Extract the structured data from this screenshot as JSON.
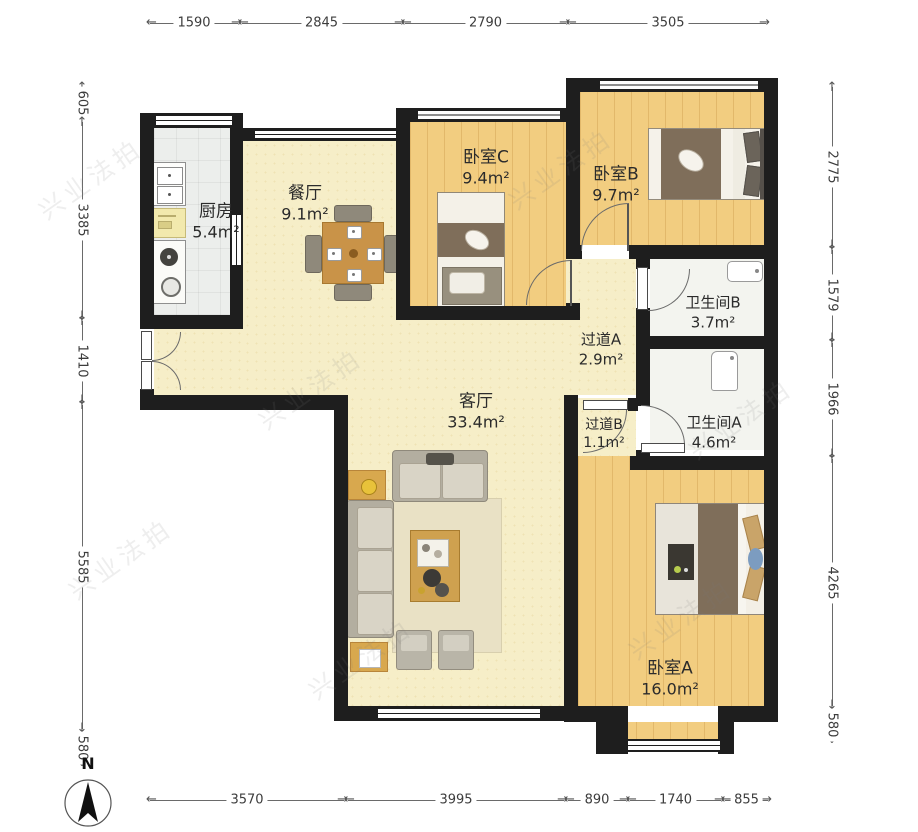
{
  "compass": {
    "label": "N"
  },
  "watermark": {
    "text": "兴业法拍"
  },
  "rooms": {
    "kitchen": {
      "name": "厨房",
      "area": "5.4m²"
    },
    "dining": {
      "name": "餐厅",
      "area": "9.1m²"
    },
    "bedroom_c": {
      "name": "卧室C",
      "area": "9.4m²"
    },
    "bedroom_b": {
      "name": "卧室B",
      "area": "9.7m²"
    },
    "bath_b": {
      "name": "卫生间B",
      "area": "3.7m²"
    },
    "hall_a": {
      "name": "过道A",
      "area": "2.9m²"
    },
    "bath_a": {
      "name": "卫生间A",
      "area": "4.6m²"
    },
    "hall_b": {
      "name": "过道B",
      "area": "1.1m²"
    },
    "living": {
      "name": "客厅",
      "area": "33.4m²"
    },
    "bedroom_a": {
      "name": "卧室A",
      "area": "16.0m²"
    }
  },
  "dimensions": {
    "top": [
      "1590",
      "2845",
      "2790",
      "3505"
    ],
    "left": [
      "605",
      "3385",
      "1410",
      "5585",
      "580"
    ],
    "right": [
      "2775",
      "1579",
      "1966",
      "4265",
      "580"
    ],
    "bottom": [
      "3570",
      "3995",
      "890",
      "1740",
      "855"
    ]
  }
}
